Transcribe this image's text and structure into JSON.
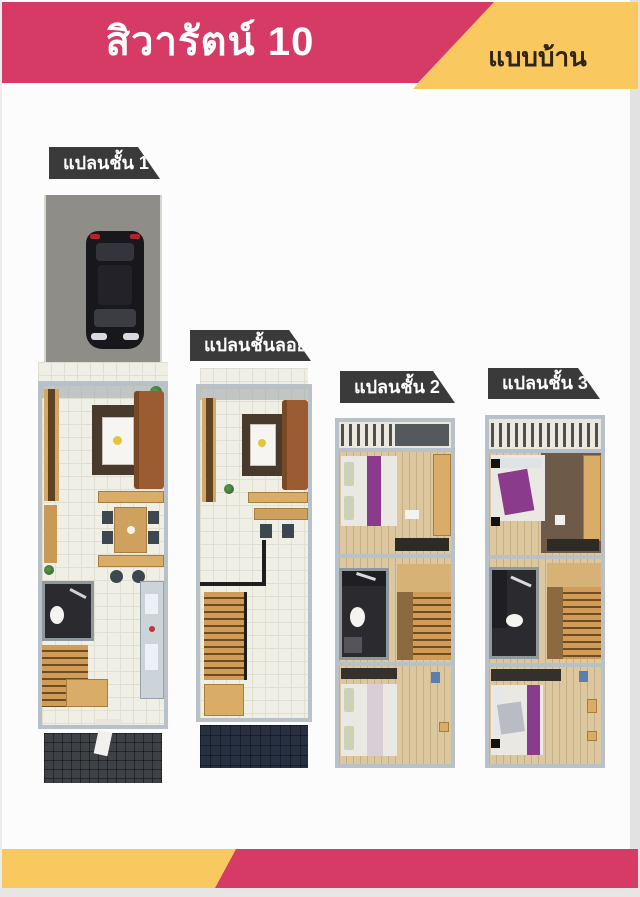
{
  "header": {
    "title": "สิวารัตน์ 10",
    "tab_label": "แบบบ้าน",
    "colors": {
      "pink": "#d53b64",
      "yellow": "#f9c85e",
      "title_text": "#ffffff",
      "tab_text": "#2f2415"
    }
  },
  "plans": [
    {
      "id": "floor-1",
      "label": "แปลนชั้น 1"
    },
    {
      "id": "mezzanine",
      "label": "แปลนชั้นลอย"
    },
    {
      "id": "floor-2",
      "label": "แปลนชั้น 2"
    },
    {
      "id": "floor-3",
      "label": "แปลนชั้น 3"
    }
  ],
  "plan_label_style": {
    "background": "#3a3a3a",
    "text": "#ffffff"
  },
  "footer": {
    "colors": {
      "yellow": "#f9c85e",
      "pink": "#d53b64"
    }
  }
}
